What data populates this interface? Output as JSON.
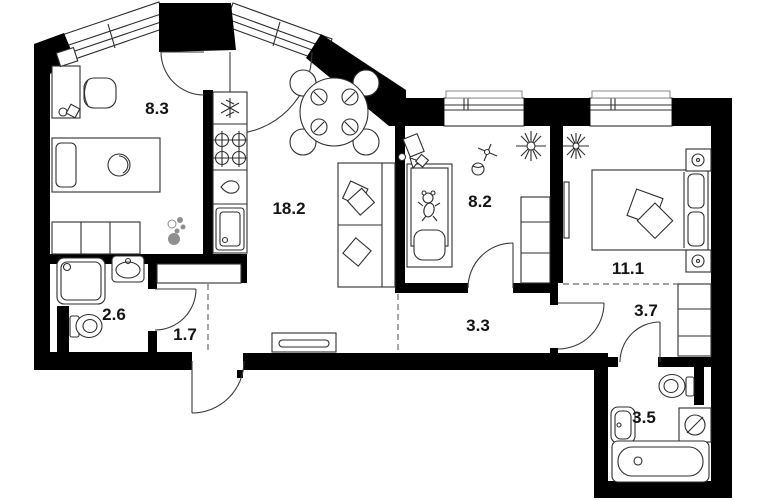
{
  "meta": {
    "type": "apartment-floor-plan",
    "style": "black-and-white architectural drawing"
  },
  "colors": {
    "background": "#ffffff",
    "wall": "#000000",
    "line": "#2e2e2e",
    "zone_dash": "#6a6a6a",
    "accent_gray": "#8f8f8f",
    "label": "#141414"
  },
  "rooms": [
    {
      "name": "bedroom-top-left",
      "area": "8.3"
    },
    {
      "name": "kitchen-living-room",
      "area": "18.2"
    },
    {
      "name": "children-room",
      "area": "8.2"
    },
    {
      "name": "bedroom-right",
      "area": "11.1"
    },
    {
      "name": "shower-room",
      "area": "2.6"
    },
    {
      "name": "entry-hall",
      "area": "1.7"
    },
    {
      "name": "corridor",
      "area": "3.3"
    },
    {
      "name": "inner-hall",
      "area": "3.7"
    },
    {
      "name": "bathroom",
      "area": "3.5"
    }
  ],
  "furniture_icons": [
    "desk",
    "office-chair",
    "single-bed",
    "storage-cabinet",
    "potted-plant",
    "fridge",
    "stove-burners",
    "kitchen-counter",
    "kitchen-sink",
    "dining-table-with-chairs",
    "sofa-with-pillows",
    "kids-bed",
    "toys",
    "ball",
    "flower-plant",
    "wardrobe",
    "double-bed",
    "nightstand",
    "wall-mirror",
    "shower-cabin",
    "washbasin",
    "toilet",
    "hall-closet",
    "bench",
    "bathtub",
    "washing-machine"
  ]
}
